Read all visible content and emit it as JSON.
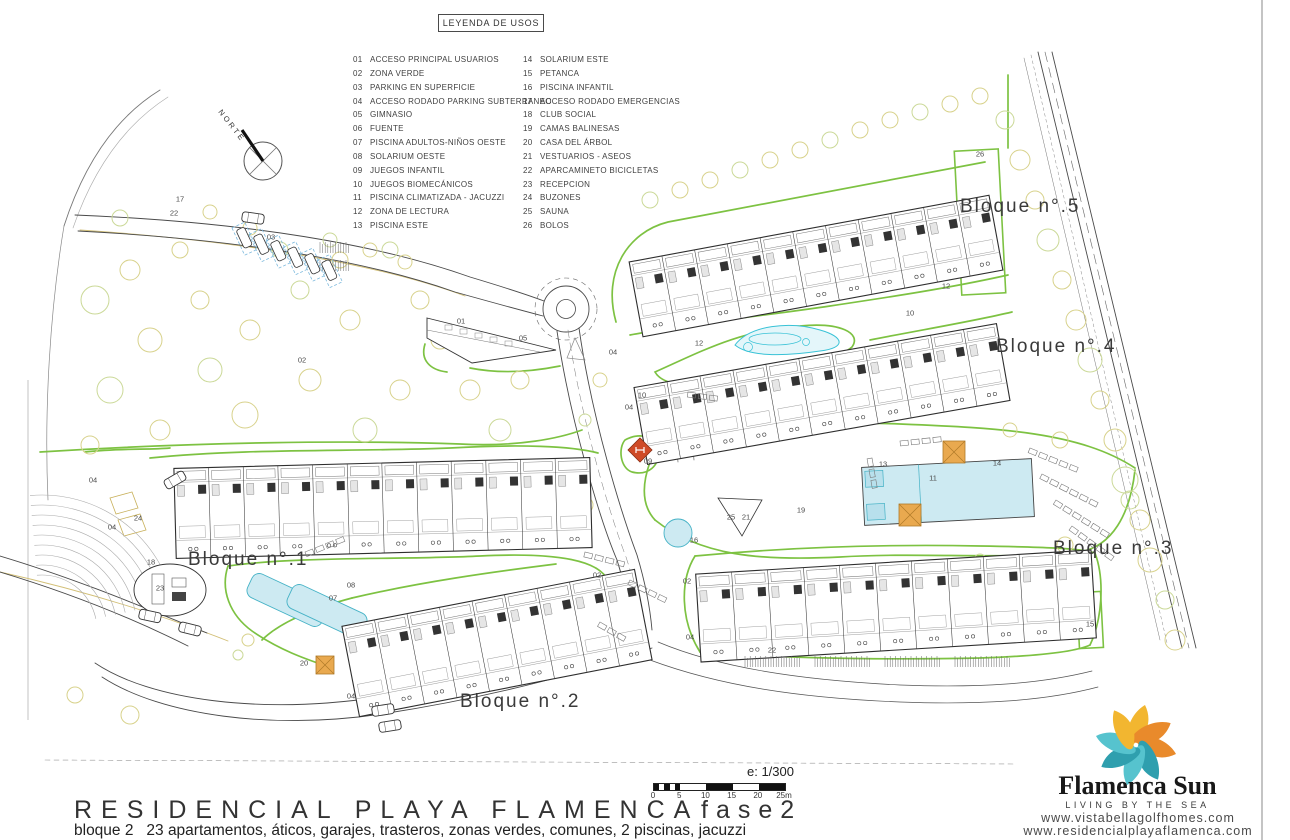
{
  "legend": {
    "title": "LEYENDA DE USOS",
    "items": [
      {
        "num": "01",
        "label": "ACCESO PRINCIPAL USUARIOS"
      },
      {
        "num": "02",
        "label": "ZONA VERDE"
      },
      {
        "num": "03",
        "label": "PARKING EN SUPERFICIE"
      },
      {
        "num": "04",
        "label": "ACCESO RODADO PARKING SUBTERRANEO"
      },
      {
        "num": "05",
        "label": "GIMNASIO"
      },
      {
        "num": "06",
        "label": "FUENTE"
      },
      {
        "num": "07",
        "label": "PISCINA ADULTOS-NIÑOS OESTE"
      },
      {
        "num": "08",
        "label": "SOLARIUM OESTE"
      },
      {
        "num": "09",
        "label": "JUEGOS INFANTIL"
      },
      {
        "num": "10",
        "label": "JUEGOS BIOMECÁNICOS"
      },
      {
        "num": "11",
        "label": "PISCINA CLIMATIZADA - JACUZZI"
      },
      {
        "num": "12",
        "label": "ZONA DE LECTURA"
      },
      {
        "num": "13",
        "label": "PISCINA ESTE"
      },
      {
        "num": "14",
        "label": "SOLARIUM ESTE"
      },
      {
        "num": "15",
        "label": "PETANCA"
      },
      {
        "num": "16",
        "label": "PISCINA INFANTIL"
      },
      {
        "num": "17",
        "label": "ACCESO RODADO EMERGENCIAS"
      },
      {
        "num": "18",
        "label": "CLUB SOCIAL"
      },
      {
        "num": "19",
        "label": "CAMAS BALINESAS"
      },
      {
        "num": "20",
        "label": "CASA DEL ÁRBOL"
      },
      {
        "num": "21",
        "label": "VESTUARIOS - ASEOS"
      },
      {
        "num": "22",
        "label": "APARCAMINETO BICICLETAS"
      },
      {
        "num": "23",
        "label": "RECEPCION"
      },
      {
        "num": "24",
        "label": "BUZONES"
      },
      {
        "num": "25",
        "label": "SAUNA"
      },
      {
        "num": "26",
        "label": "BOLOS"
      }
    ]
  },
  "north_label": "NORTE",
  "blocks": [
    {
      "label": "Bloque n°.1",
      "x": 188,
      "y": 549
    },
    {
      "label": "Bloque n°.2",
      "x": 460,
      "y": 691
    },
    {
      "label": "Bloque n°.3",
      "x": 1053,
      "y": 538
    },
    {
      "label": "Bloque n°.4",
      "x": 996,
      "y": 336
    },
    {
      "label": "Bloque n°.5",
      "x": 960,
      "y": 196
    }
  ],
  "markers": [
    {
      "n": "17",
      "x": 180,
      "y": 199
    },
    {
      "n": "22",
      "x": 174,
      "y": 213
    },
    {
      "n": "03",
      "x": 271,
      "y": 237
    },
    {
      "n": "02",
      "x": 302,
      "y": 360
    },
    {
      "n": "01",
      "x": 461,
      "y": 321
    },
    {
      "n": "05",
      "x": 523,
      "y": 338
    },
    {
      "n": "04",
      "x": 613,
      "y": 352
    },
    {
      "n": "04",
      "x": 629,
      "y": 407
    },
    {
      "n": "10",
      "x": 642,
      "y": 395
    },
    {
      "n": "10",
      "x": 910,
      "y": 313
    },
    {
      "n": "12",
      "x": 699,
      "y": 343
    },
    {
      "n": "12",
      "x": 946,
      "y": 286
    },
    {
      "n": "09",
      "x": 648,
      "y": 461
    },
    {
      "n": "16",
      "x": 694,
      "y": 540
    },
    {
      "n": "25",
      "x": 731,
      "y": 517
    },
    {
      "n": "21",
      "x": 746,
      "y": 517
    },
    {
      "n": "19",
      "x": 801,
      "y": 510
    },
    {
      "n": "02",
      "x": 597,
      "y": 575
    },
    {
      "n": "02",
      "x": 687,
      "y": 581
    },
    {
      "n": "13",
      "x": 883,
      "y": 464
    },
    {
      "n": "11",
      "x": 933,
      "y": 478
    },
    {
      "n": "14",
      "x": 997,
      "y": 463
    },
    {
      "n": "26",
      "x": 980,
      "y": 154
    },
    {
      "n": "15",
      "x": 1090,
      "y": 624
    },
    {
      "n": "22",
      "x": 772,
      "y": 650
    },
    {
      "n": "08",
      "x": 351,
      "y": 585
    },
    {
      "n": "07",
      "x": 333,
      "y": 598
    },
    {
      "n": "20",
      "x": 304,
      "y": 663
    },
    {
      "n": "18",
      "x": 151,
      "y": 562
    },
    {
      "n": "23",
      "x": 160,
      "y": 588
    },
    {
      "n": "24",
      "x": 138,
      "y": 518
    },
    {
      "n": "04",
      "x": 93,
      "y": 480
    },
    {
      "n": "04",
      "x": 112,
      "y": 527
    },
    {
      "n": "04",
      "x": 351,
      "y": 696
    },
    {
      "n": "04",
      "x": 690,
      "y": 637
    }
  ],
  "scalebar": {
    "label": "e: 1/300",
    "ticks": [
      "0",
      "5",
      "10",
      "15",
      "20",
      "25m"
    ]
  },
  "footer": {
    "title": "RESIDENCIAL PLAYA FLAMENCA",
    "phase": "fase2",
    "subtitle": "bloque 2   23 apartamentos, áticos, garajes, trasteros, zonas verdes, comunes, 2 piscinas, jacuzzi"
  },
  "logo": {
    "name": "Flamenca Sun",
    "tagline": "LIVING BY THE SEA",
    "url1": "www.vistabellagolfhomes.com",
    "url2": "www.residencialplayaflamenca.com"
  },
  "colors": {
    "green": "#7dc242",
    "tree": "#d8d28c",
    "tree2": "#cbd998",
    "pool_fill": "#cdeaf2",
    "pool_stroke": "#45b2c6",
    "cyan": "#38c2d6",
    "orange": "#e9a94f",
    "orange_stroke": "#b07a28",
    "red": "#cf4a26",
    "tan": "#d2bf76",
    "ink": "#3a3a3a"
  }
}
